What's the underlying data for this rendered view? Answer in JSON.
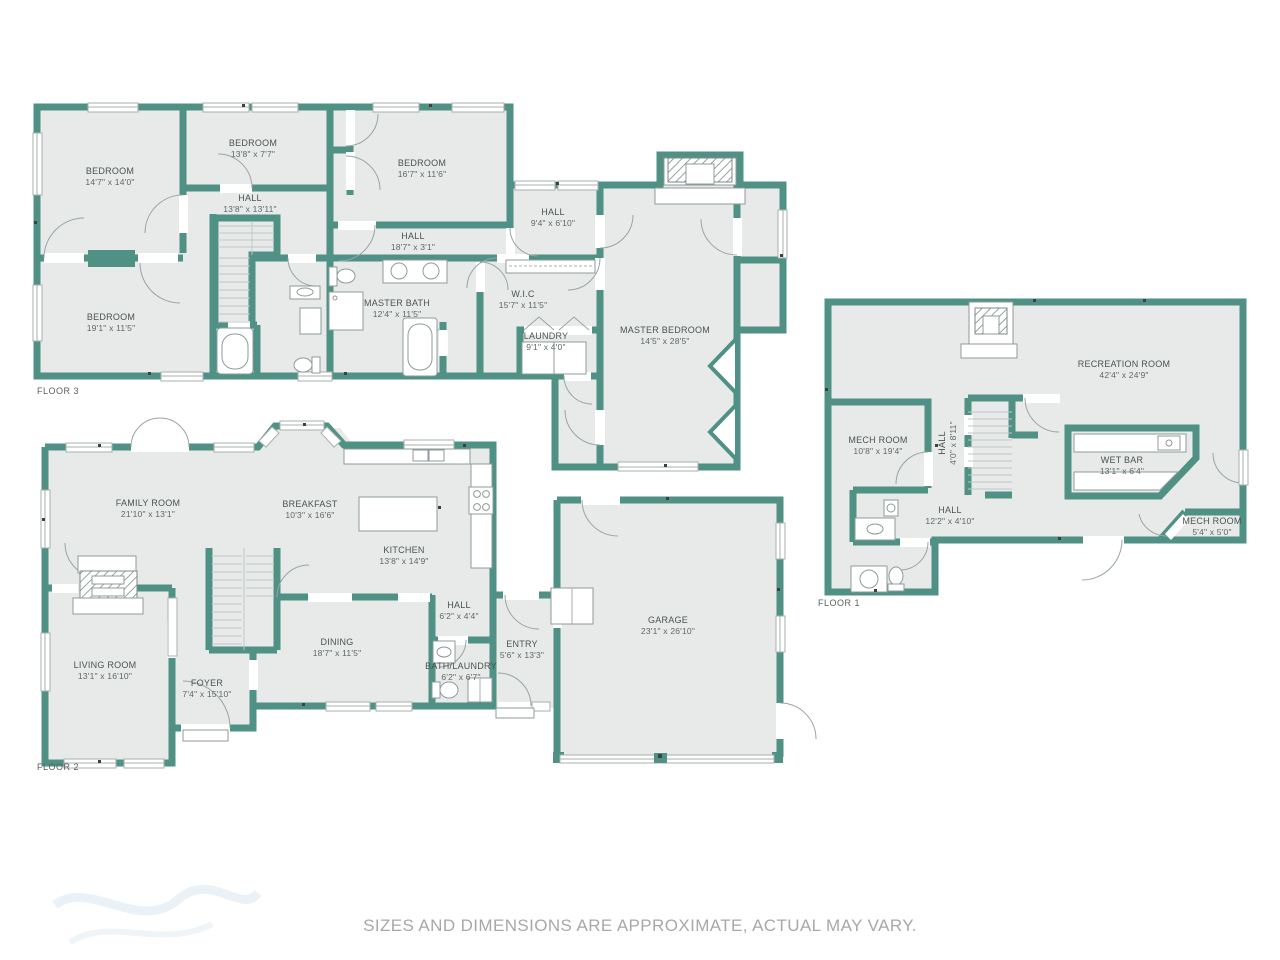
{
  "page": {
    "disclaimer": "SIZES AND DIMENSIONS ARE APPROXIMATE, ACTUAL MAY VARY."
  },
  "colors": {
    "wall": "#4f9184",
    "floor": "#e8e9e9",
    "winf": "#a7b1af",
    "door": "#98a5a3",
    "label": "#4a5453",
    "label2": "#5f6867",
    "floorlabel": "#5b605f",
    "muted": "#a8a8a8"
  },
  "floors": [
    {
      "label": "FLOOR 3",
      "rooms": [
        {
          "name": "BEDROOM",
          "dims": "14'7\" x 14'0\""
        },
        {
          "name": "BEDROOM",
          "dims": "13'8\" x 7'7\""
        },
        {
          "name": "HALL",
          "dims": "13'8\" x 13'11\""
        },
        {
          "name": "BEDROOM",
          "dims": "19'1\" x 11'5\""
        },
        {
          "name": "BEDROOM",
          "dims": "16'7\" x 11'6\""
        },
        {
          "name": "HALL",
          "dims": "18'7\" x 3'1\""
        },
        {
          "name": "HALL",
          "dims": "9'4\" x 6'10\""
        },
        {
          "name": "MASTER BATH",
          "dims": "12'4\" x 11'5\""
        },
        {
          "name": "W.I.C",
          "dims": "15'7\" x 11'5\""
        },
        {
          "name": "LAUNDRY",
          "dims": "9'1\" x 4'0\""
        },
        {
          "name": "MASTER BEDROOM",
          "dims": "14'5\" x 28'5\""
        }
      ]
    },
    {
      "label": "FLOOR 2",
      "rooms": [
        {
          "name": "FAMILY ROOM",
          "dims": "21'10\" x 13'1\""
        },
        {
          "name": "BREAKFAST",
          "dims": "10'3\" x 16'6\""
        },
        {
          "name": "KITCHEN",
          "dims": "13'8\" x 14'9\""
        },
        {
          "name": "LIVING ROOM",
          "dims": "13'1\" x 16'10\""
        },
        {
          "name": "DINING",
          "dims": "18'7\" x 11'5\""
        },
        {
          "name": "FOYER",
          "dims": "7'4\" x 15'10\""
        },
        {
          "name": "HALL",
          "dims": "6'2\" x 4'4\""
        },
        {
          "name": "ENTRY",
          "dims": "5'6\" x 13'3\""
        },
        {
          "name": "BATH/LAUNDRY",
          "dims": "6'2\" x 6'7\""
        },
        {
          "name": "GARAGE",
          "dims": "23'1\" x 26'10\""
        }
      ]
    },
    {
      "label": "FLOOR 1",
      "rooms": [
        {
          "name": "RECREATION ROOM",
          "dims": "42'4\" x 24'9\""
        },
        {
          "name": "MECH ROOM",
          "dims": "10'8\" x 19'4\""
        },
        {
          "name": "HALL",
          "dims": "4'0\" x 8'11\""
        },
        {
          "name": "WET BAR",
          "dims": "13'1\" x 6'4\""
        },
        {
          "name": "HALL",
          "dims": "12'2\" x 4'10\""
        },
        {
          "name": "MECH ROOM",
          "dims": "5'4\" x 5'0\""
        }
      ]
    }
  ]
}
